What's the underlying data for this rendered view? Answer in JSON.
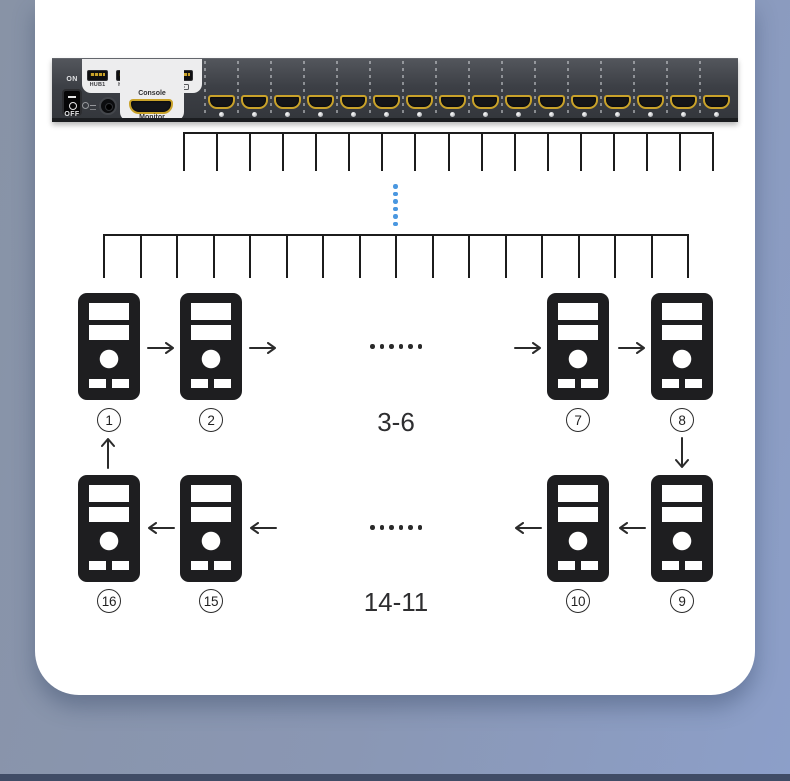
{
  "page": {
    "background_left": "#8893a6",
    "background_right": "#8c9fc9",
    "footer_strip_color": "#404c66",
    "card_color": "#ffffff"
  },
  "device": {
    "hdmi_port_count": 16,
    "accent_gold": "#c9a22a",
    "power_switch": {
      "on_label": "ON",
      "off_label": "OFF"
    },
    "console_panel": {
      "usb_ports": [
        {
          "label": "HUB1"
        },
        {
          "label": "HUB2"
        },
        {
          "icon": "mouse-icon"
        },
        {
          "icon": "keyboard-icon"
        }
      ],
      "console_label": "Console",
      "monitor_label": "Monitor"
    }
  },
  "diagram": {
    "top_cable_comb_teeth": 17,
    "bottom_cable_comb_teeth": 17,
    "dotted_link_dot_count": 6,
    "dotted_link_color": "#4a97e0",
    "ellipsis_dot_count": 6,
    "top_row": {
      "computers": [
        {
          "num": "1"
        },
        {
          "num": "2"
        },
        {
          "num": "7"
        },
        {
          "num": "8"
        }
      ],
      "range_label": "3-6"
    },
    "bottom_row": {
      "computers": [
        {
          "num": "16"
        },
        {
          "num": "15"
        },
        {
          "num": "10"
        },
        {
          "num": "9"
        }
      ],
      "range_label": "14-11"
    }
  }
}
